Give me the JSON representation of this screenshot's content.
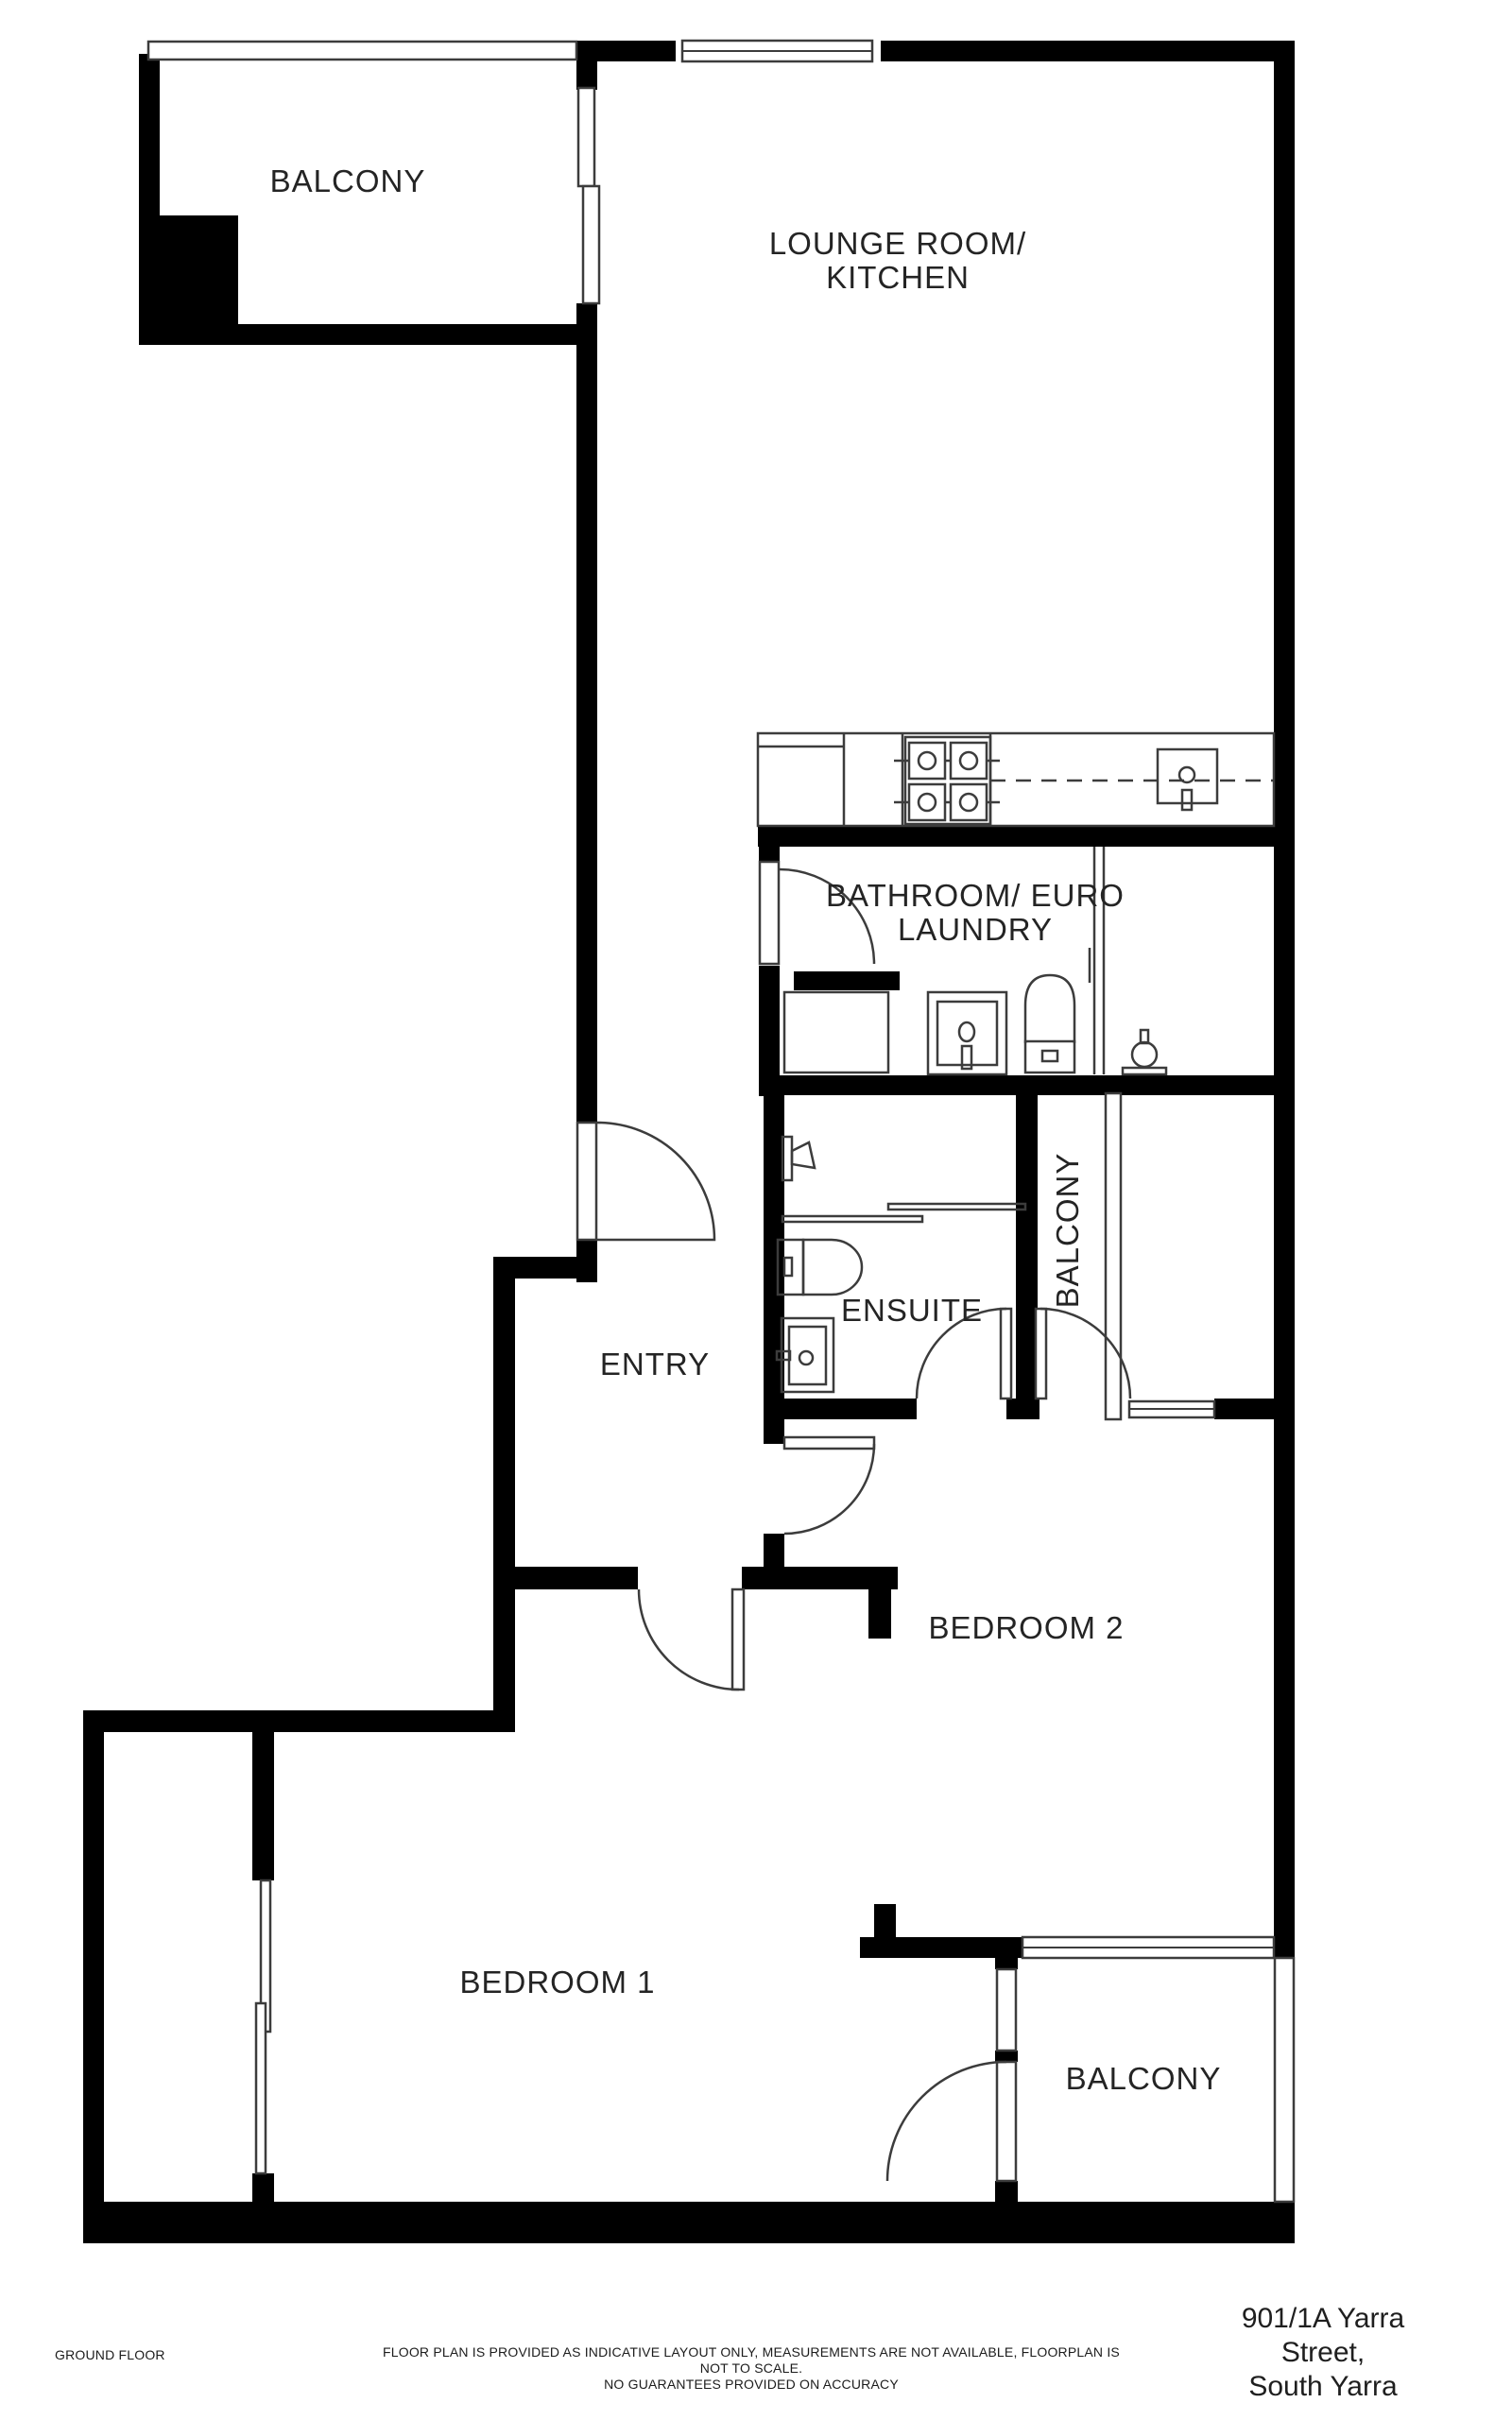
{
  "document": {
    "type": "floor-plan",
    "floor_label": "GROUND FLOOR",
    "address_line1": "901/1A Yarra Street,",
    "address_line2": "South Yarra",
    "disclaimer_line1": "FLOOR PLAN IS PROVIDED AS INDICATIVE LAYOUT ONLY, MEASUREMENTS ARE NOT AVAILABLE, FLOORPLAN IS NOT TO SCALE.",
    "disclaimer_line2": "NO GUARANTEES PROVIDED ON ACCURACY"
  },
  "rooms": [
    {
      "name": "balcony-top-left",
      "lines": [
        "BALCONY"
      ]
    },
    {
      "name": "lounge-kitchen",
      "lines": [
        "LOUNGE ROOM/",
        "KITCHEN"
      ]
    },
    {
      "name": "bathroom-euro-laundry",
      "lines": [
        "BATHROOM/ EURO",
        "LAUNDRY"
      ]
    },
    {
      "name": "ensuite",
      "lines": [
        "ENSUITE"
      ]
    },
    {
      "name": "balcony-right",
      "lines": [
        "BALCONY"
      ]
    },
    {
      "name": "entry",
      "lines": [
        "ENTRY"
      ]
    },
    {
      "name": "bedroom-2",
      "lines": [
        "BEDROOM 2"
      ]
    },
    {
      "name": "bedroom-1",
      "lines": [
        "BEDROOM 1"
      ]
    },
    {
      "name": "balcony-bottom",
      "lines": [
        "BALCONY"
      ]
    }
  ],
  "fixtures": [
    "cooktop-icon",
    "kitchen-sink-icon",
    "bathroom-basin-icon",
    "bathroom-toilet-icon",
    "shower-head-icon",
    "ensuite-shower-tap-icon",
    "ensuite-toilet-icon",
    "ensuite-vanity-icon"
  ],
  "colors": {
    "wall": "#000000",
    "line": "#3c3c3c",
    "text": "#242424",
    "background": "#ffffff"
  }
}
